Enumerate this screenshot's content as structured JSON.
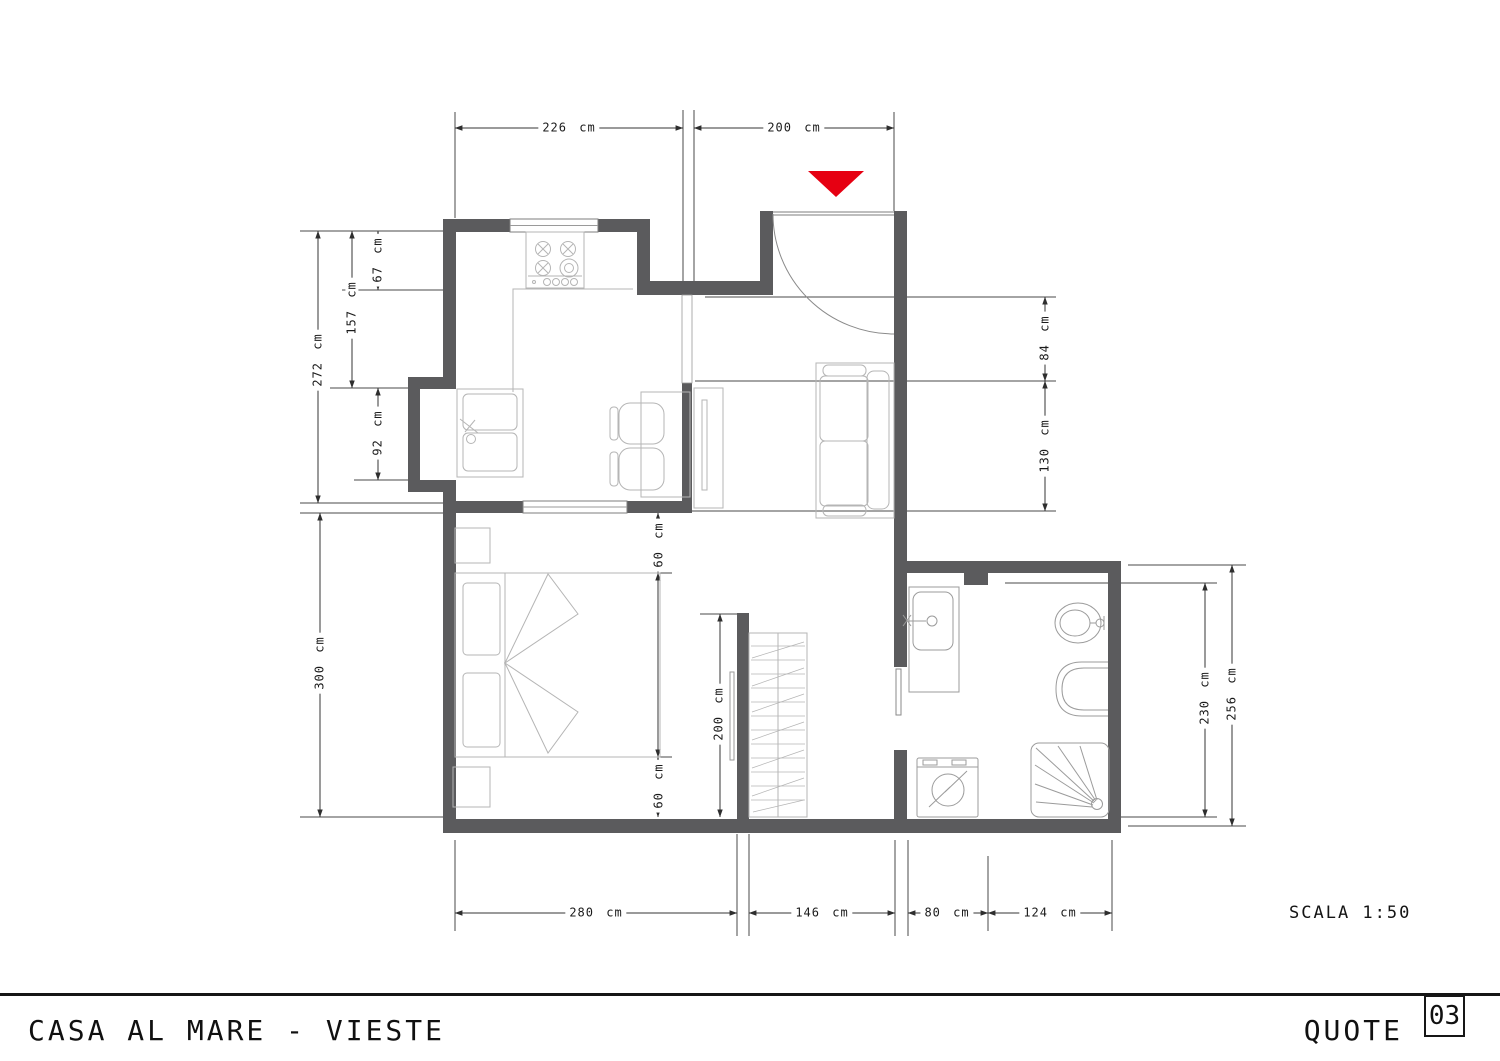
{
  "title_block": {
    "project_title": "CASA AL MARE - VIESTE",
    "sheet_label": "QUOTE",
    "sheet_number": "03"
  },
  "scale": {
    "label": "SCALA 1:50"
  },
  "dims": {
    "top_kitchen": "226 cm",
    "top_entrance": "200 cm",
    "left_stove_depth": "67 cm",
    "left_kitchen_upper": "157 cm",
    "left_kitchen_total": "272 cm",
    "left_niche": "92 cm",
    "left_bedroom": "300 cm",
    "right_entry_depth": "84 cm",
    "right_sofa": "130 cm",
    "right_bath_inner": "230 cm",
    "right_bath_outer": "256 cm",
    "bottom_bedroom": "280 cm",
    "bottom_hall": "146 cm",
    "bottom_bath_door": "80 cm",
    "bottom_bath": "124 cm",
    "bed_gap_top": "60 cm",
    "bed_gap_bottom": "60 cm",
    "wardrobe_wall": "200 cm"
  },
  "colors": {
    "wall": "#5b5b5d",
    "dimension_line": "#3a3a3a",
    "extension_line": "#4a4a4a",
    "furniture_line": "#b5b5b5",
    "fixture_line": "#9b9b9b",
    "entrance_marker_red": "#e60012",
    "titlebar_black": "#151515"
  },
  "symbols": [
    "entrance-arrow",
    "door-swing",
    "window",
    "stove",
    "kitchen-sink",
    "dining-table",
    "chair",
    "tv-unit",
    "sofa",
    "double-bed",
    "pillow",
    "nightstand",
    "wardrobe",
    "washbasin",
    "bidet",
    "toilet",
    "shower",
    "washing-machine"
  ]
}
